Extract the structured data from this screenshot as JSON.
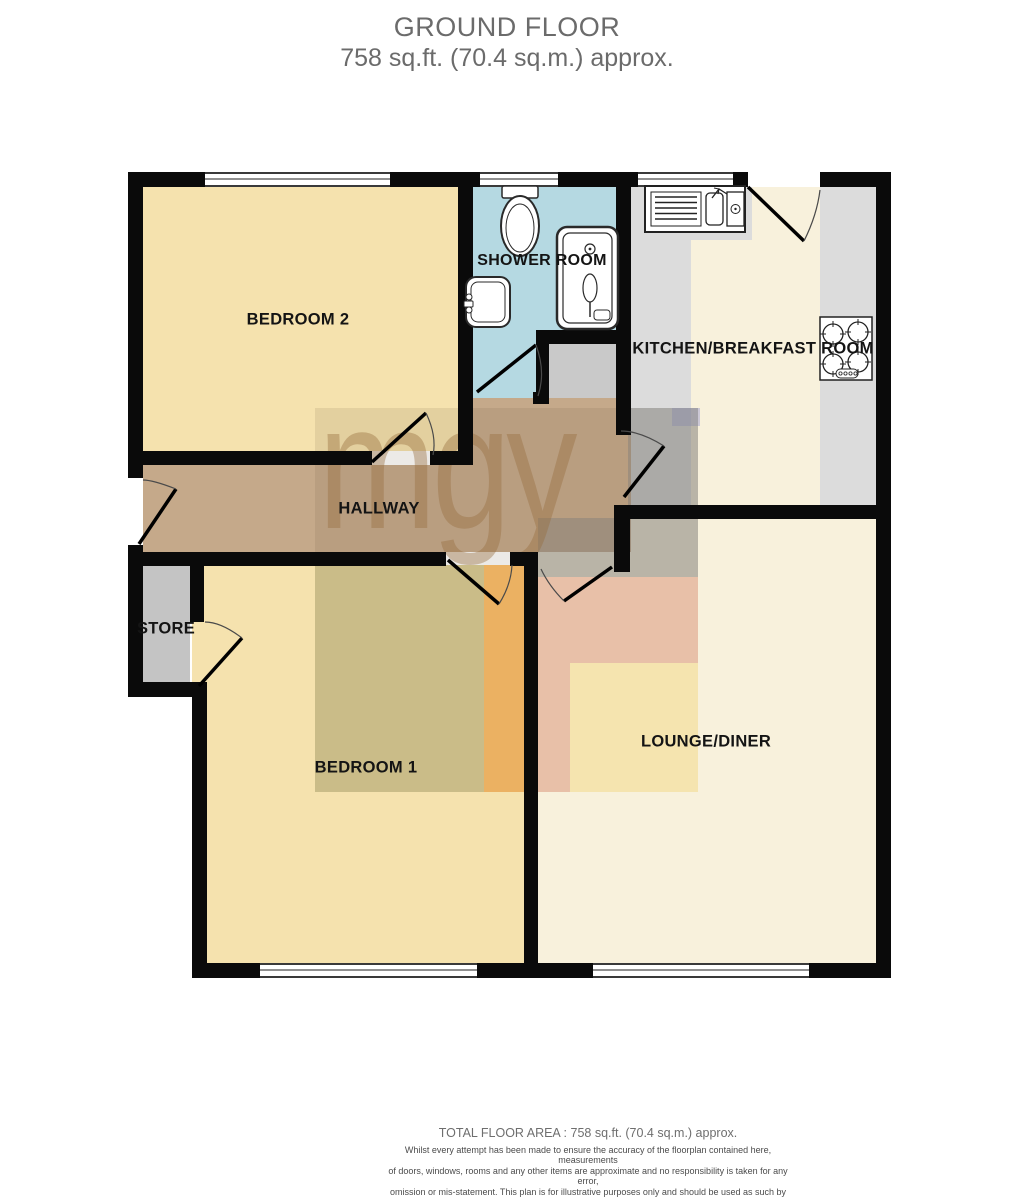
{
  "title": {
    "floor": "GROUND FLOOR",
    "area": "758 sq.ft. (70.4 sq.m.) approx."
  },
  "rooms": {
    "bedroom2": {
      "label": "BEDROOM 2"
    },
    "shower": {
      "label": "SHOWER ROOM"
    },
    "kitchen": {
      "label": "KITCHEN/BREAKFAST ROOM"
    },
    "hallway": {
      "label": "HALLWAY"
    },
    "store": {
      "label": "STORE"
    },
    "bedroom1": {
      "label": "BEDROOM 1"
    },
    "lounge": {
      "label": "LOUNGE/DINER"
    }
  },
  "watermark": {
    "text": "mgy"
  },
  "footer": {
    "total_area": "TOTAL FLOOR AREA : 758 sq.ft. (70.4 sq.m.) approx.",
    "disclaimer": [
      "Whilst every attempt has been made to ensure the accuracy of the floorplan contained here, measurements",
      "of doors, windows, rooms and any other items are approximate and no responsibility is taken for any error,",
      "omission or mis-statement. This plan is for illustrative purposes only and should be used as such by any",
      "prospective purchaser. The services, systems and appliances shown have not been tested and no guarantee",
      "as to their operability or efficiency can be given."
    ],
    "credit": "Made with Metropix ©2022"
  },
  "colors": {
    "room-yellow": "#f5e2ae",
    "room-cream": "#f8f1dc",
    "room-blue": "#b5d9e2",
    "room-brown": "#c5a98a",
    "room-gray": "#c4c4c4",
    "counter-gray": "#dcdcdc",
    "wall": "#0a0a0a",
    "title-gray": "#6b6b6b",
    "watermark-tan": "rgba(150,108,60,0.40)"
  }
}
